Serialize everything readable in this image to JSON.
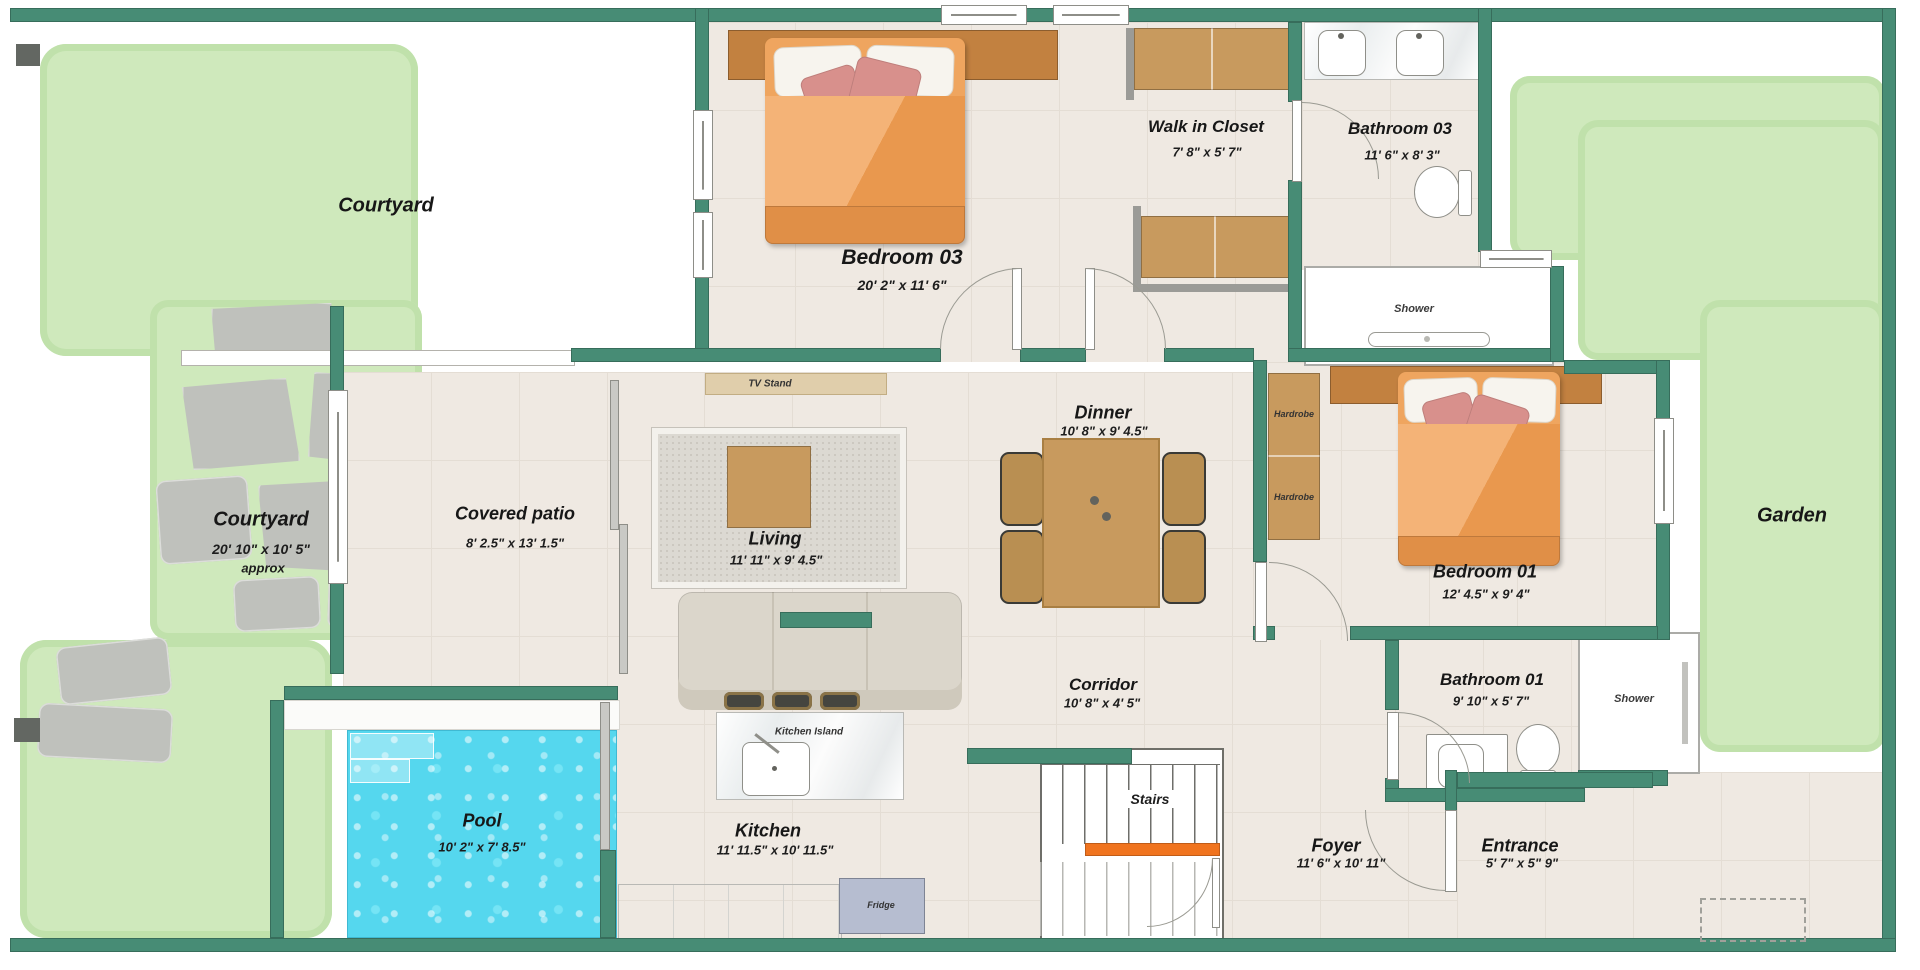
{
  "palette": {
    "wall": "#478C75",
    "grass": "#CFE9BC",
    "grass_edge": "#C0E1AB",
    "floor": "#EFE9E2",
    "tile_line": "#E4DDD4",
    "paver": "#BFC1BC",
    "pool": "#55D7EE",
    "wood": "#C89A5E",
    "headboard": "#C28140",
    "bed": "#EFA55F",
    "bed_foot": "#E08F47",
    "pillow_pink": "#D8908C",
    "sofa": "#DBD6CB",
    "stair_accent": "#F0741F",
    "fridge": "#B6BDD0",
    "gray_wall": "#9B9B97"
  },
  "labels": {
    "courtyard_top": {
      "name": "Courtyard"
    },
    "courtyard_paved": {
      "name": "Courtyard",
      "dims": "20' 10\" x 10' 5\"",
      "note": "approx"
    },
    "bedroom03": {
      "name": "Bedroom 03",
      "dims": "20' 2\" x 11' 6\""
    },
    "walk_in_closet": {
      "name": "Walk in Closet",
      "dims": "7' 8\" x 5' 7\""
    },
    "bathroom03": {
      "name": "Bathroom 03",
      "dims": "11' 6\" x 8' 3\""
    },
    "shower03": {
      "name": "Shower"
    },
    "garden": {
      "name": "Garden"
    },
    "covered_patio": {
      "name": "Covered patio",
      "dims": "8' 2.5\" x 13' 1.5\""
    },
    "living": {
      "name": "Living",
      "dims": "11' 11\" x 9' 4.5\""
    },
    "dinner": {
      "name": "Dinner",
      "dims": "10' 8\" x 9' 4.5\""
    },
    "tv_stand": {
      "name": "TV Stand"
    },
    "bedroom01": {
      "name": "Bedroom 01",
      "dims": "12' 4.5\" x 9' 4\""
    },
    "hardrobe_top": {
      "name": "Hardrobe"
    },
    "hardrobe_bottom": {
      "name": "Hardrobe"
    },
    "corridor": {
      "name": "Corridor",
      "dims": "10' 8\" x 4' 5\""
    },
    "bathroom01": {
      "name": "Bathroom 01",
      "dims": "9' 10\" x 5' 7\""
    },
    "shower01": {
      "name": "Shower"
    },
    "pool": {
      "name": "Pool",
      "dims": "10' 2\" x 7' 8.5\""
    },
    "kitchen": {
      "name": "Kitchen",
      "dims": "11' 11.5\" x 10' 11.5\""
    },
    "kitchen_island": {
      "name": "Kitchen Island"
    },
    "fridge": {
      "name": "Fridge"
    },
    "stairs": {
      "name": "Stairs"
    },
    "foyer": {
      "name": "Foyer",
      "dims": "11' 6\" x 10' 11\""
    },
    "entrance": {
      "name": "Entrance",
      "dims": "5' 7\" x 5\" 9\""
    }
  }
}
